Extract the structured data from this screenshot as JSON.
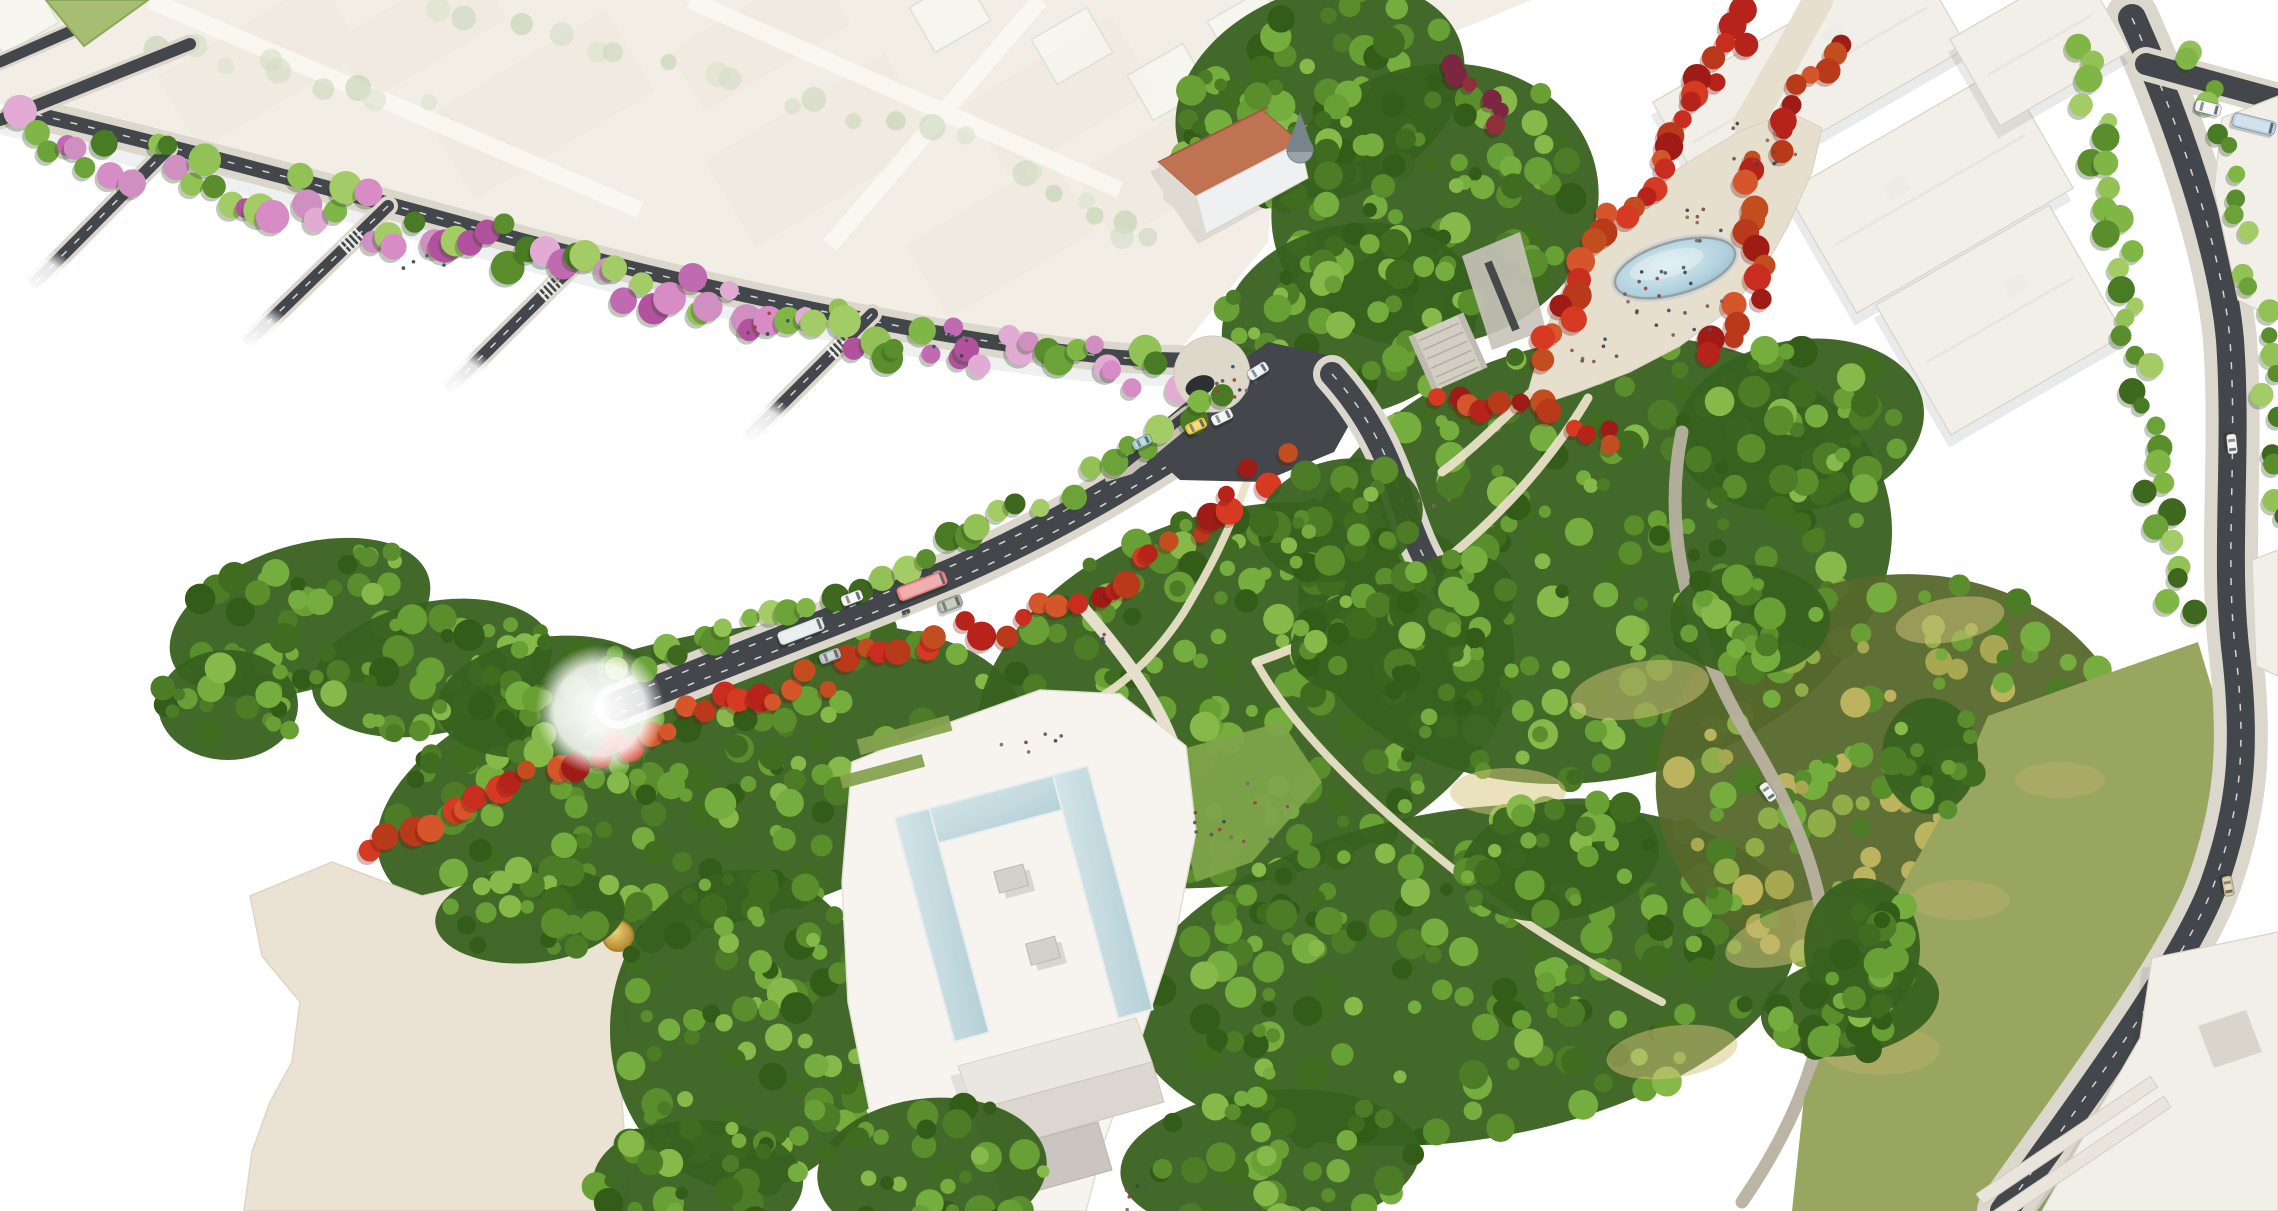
{
  "scene": {
    "title": "Aerial architectural rendering of an urban masterplan: tree-lined boulevard with buses, red-tree promenade with oval fountain, dense park, museum forecourt with U-shaped reflecting pool, white massing buildings and faded city context",
    "type": "architectural-visualization",
    "view": "aerial-isometric"
  },
  "colors": {
    "bg": "#ffffff",
    "fadedBase": "#ece4d5",
    "fadedBlock": "#e3d9c6",
    "fadedStreet": "#f7f3ea",
    "road": "#43474b",
    "roadDark": "#303438",
    "sidewalk": "#dcd7cd",
    "promenade": "#e7dfce",
    "pathLight": "#e9e0c7",
    "gravel": "#b8b1a0",
    "parkBase": "#38611f",
    "parkBaseYellow": "#56682c",
    "oliveLawn": "#98a65f",
    "beigeLot": "#eae2d3",
    "plazaWhite": "#f7f4ef",
    "buildingWhite": "#f2efe9",
    "buildingStroke": "#d8d3c9",
    "buildingShade": "#dfdbd2",
    "buildingDark": "#c7c3bb",
    "terracotta": "#bf7352",
    "terracottaDark": "#a05a40",
    "turret": "#9aa4a8",
    "turretDark": "#77858a",
    "pondRim": "#98a0a4",
    "laneDash": "#eceeea",
    "crosswalk": "#f7f7f4",
    "shadow": "#8d939c",
    "lawnBright": "#7fa44b",
    "hedge": "#86a24f",
    "glass": "rgba(246,250,243,0.55)",
    "glassStroke": "#c4cfbd"
  },
  "palettes": {
    "green": [
      "#497a24",
      "#5a8e2d",
      "#6ca338",
      "#7fb646",
      "#92c256",
      "#3d681d",
      "#a3cc66"
    ],
    "mixGreenPink": [
      "#5a8e2d",
      "#6ca338",
      "#7fb646",
      "#92c256",
      "#c06ab2",
      "#b2519e",
      "#d78cc5",
      "#e2abd3",
      "#497a24",
      "#a3cc66",
      "#cf8fc0"
    ],
    "red": [
      "#b5231b",
      "#c92d1f",
      "#d63a22",
      "#9e1c15",
      "#c24e1f",
      "#d4562a",
      "#b93a1a"
    ],
    "ghost": [
      "#aabf92",
      "#b9c8a1",
      "#c6d2ad",
      "#9db581"
    ],
    "park": [
      "#3f6c1e",
      "#4c7d26",
      "#5a8e2d",
      "#68a036",
      "#76ad3f",
      "#335c18",
      "#86b94a"
    ],
    "parkYellow": [
      "#4c7d26",
      "#5a8e2d",
      "#76ad3f",
      "#8fae4a",
      "#a8a852",
      "#bcb35e",
      "#68a036"
    ],
    "accent": [
      "#7c2742",
      "#8e2f3a",
      "#6e2030"
    ],
    "people": [
      "#3a3f4a",
      "#6b4a3a",
      "#874f5a",
      "#2f4a6b",
      "#4f555e",
      "#7a6a5a",
      "#a03c3c"
    ],
    "shadows": {
      "green": "#2c481a",
      "mixGreenPink": "#2c481a",
      "park": "#24420f",
      "parkYellow": "#3a4a14",
      "red": "#6e1410",
      "accent": "#451020",
      "ghost": "none"
    }
  },
  "canopy": {
    "bands": [
      {
        "name": "quay-avenue-row",
        "layer": "g-quay-trees",
        "points": [
          [
            15,
            132
          ],
          [
            180,
            172
          ],
          [
            350,
            212
          ],
          [
            520,
            252
          ],
          [
            700,
            296
          ],
          [
            870,
            332
          ],
          [
            1020,
            360
          ],
          [
            1160,
            374
          ],
          [
            1268,
            360
          ]
        ],
        "n": 88,
        "spread": 24,
        "r": [
          9,
          17
        ],
        "palette": "mixGreenPink"
      },
      {
        "name": "boulevard-upper-row",
        "layer": "g-blvd-trees",
        "points": [
          [
            608,
            684
          ],
          [
            700,
            646
          ],
          [
            790,
            610
          ],
          [
            880,
            576
          ],
          [
            960,
            540
          ],
          [
            1040,
            502
          ],
          [
            1110,
            464
          ],
          [
            1170,
            428
          ],
          [
            1240,
            386
          ]
        ],
        "n": 30,
        "spread": 13,
        "r": [
          9,
          15
        ],
        "palette": "green"
      },
      {
        "name": "boulevard-red-band",
        "layer": "g-blvd-trees",
        "points": [
          [
            368,
            847
          ],
          [
            470,
            797
          ],
          [
            560,
            759
          ],
          [
            650,
            727
          ],
          [
            735,
            702
          ],
          [
            820,
            677
          ],
          [
            900,
            652
          ],
          [
            980,
            630
          ],
          [
            1055,
            610
          ],
          [
            1110,
            582
          ],
          [
            1155,
            550
          ],
          [
            1200,
            517
          ],
          [
            1245,
            484
          ],
          [
            1292,
            457
          ]
        ],
        "n": 52,
        "spread": 15,
        "r": [
          8,
          15
        ],
        "palette": "red"
      },
      {
        "name": "promenade-red-west",
        "layer": "g-promenade-trees",
        "points": [
          [
            1758,
            12
          ],
          [
            1718,
            72
          ],
          [
            1676,
            132
          ],
          [
            1636,
            192
          ],
          [
            1596,
            252
          ],
          [
            1566,
            312
          ],
          [
            1548,
            368
          ]
        ],
        "n": 30,
        "spread": 15,
        "r": [
          9,
          15
        ],
        "palette": "red"
      },
      {
        "name": "promenade-red-east",
        "layer": "g-promenade-trees",
        "points": [
          [
            1838,
            35
          ],
          [
            1800,
            95
          ],
          [
            1768,
            150
          ],
          [
            1752,
            205
          ],
          [
            1764,
            262
          ],
          [
            1742,
            318
          ],
          [
            1700,
            360
          ]
        ],
        "n": 24,
        "spread": 13,
        "r": [
          8,
          14
        ],
        "palette": "red"
      },
      {
        "name": "promenade-red-south",
        "layer": "g-promenade-trees",
        "points": [
          [
            1432,
            390
          ],
          [
            1470,
            416
          ],
          [
            1528,
            400
          ],
          [
            1580,
            424
          ],
          [
            1628,
            442
          ]
        ],
        "n": 12,
        "spread": 12,
        "r": [
          8,
          13
        ],
        "palette": "red"
      },
      {
        "name": "purple-accents",
        "layer": "g-park-over",
        "points": [
          [
            1448,
            52
          ],
          [
            1482,
            92
          ],
          [
            1506,
            132
          ]
        ],
        "n": 6,
        "spread": 14,
        "r": [
          7,
          12
        ],
        "palette": "accent"
      },
      {
        "name": "street-row-west",
        "layer": "g-street-trees",
        "points": [
          [
            2085,
            42
          ],
          [
            2100,
            142
          ],
          [
            2118,
            242
          ],
          [
            2134,
            332
          ],
          [
            2150,
            432
          ],
          [
            2160,
            532
          ],
          [
            2186,
            622
          ]
        ],
        "n": 34,
        "spread": 15,
        "r": [
          8,
          14
        ],
        "palette": "green"
      },
      {
        "name": "street-row-east",
        "layer": "g-street-trees",
        "points": [
          [
            2192,
            30
          ],
          [
            2216,
            130
          ],
          [
            2246,
            230
          ],
          [
            2262,
            330
          ],
          [
            2270,
            430
          ],
          [
            2273,
            530
          ]
        ],
        "n": 22,
        "spread": 12,
        "r": [
          8,
          13
        ],
        "palette": "green"
      },
      {
        "name": "ghost-row-a",
        "layer": "g-ghost",
        "points": [
          [
            420,
            6
          ],
          [
            560,
            40
          ],
          [
            700,
            76
          ],
          [
            850,
            112
          ],
          [
            990,
            146
          ]
        ],
        "n": 15,
        "spread": 9,
        "r": [
          8,
          14
        ],
        "palette": "ghost",
        "opacity": 0.6
      },
      {
        "name": "ghost-row-b",
        "layer": "g-ghost",
        "points": [
          [
            150,
            40
          ],
          [
            290,
            72
          ],
          [
            430,
            106
          ]
        ],
        "n": 9,
        "spread": 9,
        "r": [
          8,
          14
        ],
        "palette": "ghost",
        "opacity": 0.6
      },
      {
        "name": "ghost-row-c",
        "layer": "g-ghost",
        "points": [
          [
            1010,
            168
          ],
          [
            1092,
            212
          ],
          [
            1164,
            252
          ]
        ],
        "n": 8,
        "spread": 9,
        "r": [
          8,
          13
        ],
        "palette": "ghost",
        "opacity": 0.6
      }
    ],
    "blobs": [
      {
        "cx": 700,
        "cy": 782,
        "rx": 330,
        "ry": 145,
        "rot": -13,
        "n": 165,
        "palette": "park"
      },
      {
        "cx": 1245,
        "cy": 695,
        "rx": 275,
        "ry": 185,
        "rot": -16,
        "n": 165,
        "palette": "park"
      },
      {
        "cx": 1595,
        "cy": 560,
        "rx": 300,
        "ry": 220,
        "rot": -12,
        "n": 190,
        "palette": "park"
      },
      {
        "cx": 1465,
        "cy": 975,
        "rx": 335,
        "ry": 165,
        "rot": -9,
        "n": 170,
        "palette": "park"
      },
      {
        "cx": 1895,
        "cy": 775,
        "rx": 240,
        "ry": 200,
        "rot": -8,
        "n": 130,
        "palette": "parkYellow"
      },
      {
        "cx": 1320,
        "cy": 95,
        "rx": 150,
        "ry": 105,
        "rot": -22,
        "n": 72,
        "palette": "park"
      },
      {
        "cx": 1435,
        "cy": 205,
        "rx": 165,
        "ry": 140,
        "rot": -14,
        "n": 88,
        "palette": "park"
      },
      {
        "cx": 1350,
        "cy": 320,
        "rx": 130,
        "ry": 95,
        "rot": -14,
        "n": 56,
        "palette": "park"
      },
      {
        "cx": 300,
        "cy": 618,
        "rx": 135,
        "ry": 72,
        "rot": -18,
        "n": 44,
        "palette": "park"
      },
      {
        "cx": 432,
        "cy": 668,
        "rx": 122,
        "ry": 66,
        "rot": -12,
        "n": 38,
        "palette": "park"
      },
      {
        "cx": 548,
        "cy": 697,
        "rx": 112,
        "ry": 60,
        "rot": -8,
        "n": 34,
        "palette": "park"
      },
      {
        "cx": 228,
        "cy": 705,
        "rx": 70,
        "ry": 55,
        "rot": 0,
        "n": 18,
        "palette": "park"
      },
      {
        "cx": 1800,
        "cy": 425,
        "rx": 125,
        "ry": 85,
        "rot": -10,
        "n": 42,
        "palette": "park"
      },
      {
        "cx": 1270,
        "cy": 1162,
        "rx": 150,
        "ry": 72,
        "rot": -5,
        "n": 40,
        "palette": "park"
      },
      {
        "cx": 530,
        "cy": 915,
        "rx": 95,
        "ry": 48,
        "rot": -5,
        "n": 26,
        "palette": "park",
        "layer": "g-lot-trees"
      },
      {
        "cx": 745,
        "cy": 1030,
        "rx": 135,
        "ry": 160,
        "rot": 0,
        "n": 88,
        "palette": "park",
        "layer": "g-lot-trees"
      },
      {
        "cx": 698,
        "cy": 1182,
        "rx": 105,
        "ry": 62,
        "rot": 0,
        "n": 30,
        "palette": "park",
        "layer": "g-lot-trees"
      },
      {
        "cx": 1380,
        "cy": 640,
        "rx": 90,
        "ry": 55,
        "rot": -10,
        "n": 26,
        "palette": "park",
        "layer": "g-park-over"
      },
      {
        "cx": 1560,
        "cy": 860,
        "rx": 100,
        "ry": 60,
        "rot": -10,
        "n": 28,
        "palette": "park",
        "layer": "g-park-over"
      },
      {
        "cx": 1750,
        "cy": 620,
        "rx": 80,
        "ry": 55,
        "rot": 0,
        "n": 22,
        "palette": "park",
        "layer": "g-park-over"
      },
      {
        "cx": 1452,
        "cy": 600,
        "rx": 64,
        "ry": 46,
        "rot": -14,
        "n": 18,
        "palette": "park",
        "layer": "g-blvd-trees"
      },
      {
        "cx": 1340,
        "cy": 520,
        "rx": 84,
        "ry": 60,
        "rot": -14,
        "n": 26,
        "palette": "park",
        "layer": "g-blvd-trees"
      },
      {
        "cx": 932,
        "cy": 1170,
        "rx": 115,
        "ry": 72,
        "rot": -5,
        "n": 34,
        "palette": "park",
        "layer": "g-blvd-trees"
      },
      {
        "cx": 1850,
        "cy": 1005,
        "rx": 90,
        "ry": 50,
        "rot": -10,
        "n": 24,
        "palette": "park",
        "layer": "g-street-trees"
      },
      {
        "cx": 1862,
        "cy": 948,
        "rx": 58,
        "ry": 70,
        "rot": 0,
        "n": 18,
        "palette": "park",
        "layer": "g-street-trees"
      },
      {
        "cx": 1930,
        "cy": 756,
        "rx": 48,
        "ry": 58,
        "rot": 0,
        "n": 14,
        "palette": "park",
        "layer": "g-street-trees"
      }
    ]
  },
  "crosswalks": [
    {
      "x": 142,
      "y": 176,
      "a": 135,
      "n": 5,
      "len": 15
    },
    {
      "x": 360,
      "y": 233,
      "a": 137,
      "n": 5,
      "len": 15
    },
    {
      "x": 558,
      "y": 280,
      "a": 137,
      "n": 5,
      "len": 15
    },
    {
      "x": 848,
      "y": 338,
      "a": 137,
      "n": 5,
      "len": 15
    },
    {
      "x": 2186,
      "y": 76,
      "a": 15,
      "n": 6,
      "len": 16
    },
    {
      "x": 1336,
      "y": 412,
      "a": 46,
      "n": 5,
      "len": 16
    }
  ],
  "vehicles": [
    {
      "type": "bus",
      "color": "#e88585",
      "x": 922,
      "y": 586,
      "angle": -21,
      "w": 52,
      "h": 15
    },
    {
      "type": "bus",
      "color": "#dfe9e6",
      "x": 801,
      "y": 631,
      "angle": -21,
      "w": 48,
      "h": 14
    },
    {
      "type": "car",
      "color": "#f4f4f2",
      "x": 852,
      "y": 598,
      "angle": -21,
      "w": 22,
      "h": 11
    },
    {
      "type": "car",
      "color": "#b9bdc4",
      "x": 830,
      "y": 656,
      "angle": -21,
      "w": 22,
      "h": 11
    },
    {
      "type": "van",
      "color": "#aab3a0",
      "x": 950,
      "y": 604,
      "angle": -21,
      "w": 25,
      "h": 12
    },
    {
      "type": "moto",
      "color": "#494f56",
      "x": 906,
      "y": 612,
      "angle": -21,
      "w": 8,
      "h": 4
    },
    {
      "type": "car",
      "color": "#ecc93e",
      "x": 1196,
      "y": 426,
      "angle": -26,
      "w": 22,
      "h": 11
    },
    {
      "type": "car",
      "color": "#f2f2f0",
      "x": 1222,
      "y": 417,
      "angle": -26,
      "w": 22,
      "h": 11
    },
    {
      "type": "car",
      "color": "#eef0f2",
      "x": 1258,
      "y": 371,
      "angle": -32,
      "w": 22,
      "h": 11
    },
    {
      "type": "car",
      "color": "#9fd0cd",
      "x": 1142,
      "y": 442,
      "angle": -26,
      "w": 20,
      "h": 10
    },
    {
      "type": "van",
      "color": "#f4f4f2",
      "x": 2208,
      "y": 108,
      "angle": 14,
      "w": 26,
      "h": 12
    },
    {
      "type": "bus",
      "color": "#b8d3e2",
      "x": 2254,
      "y": 124,
      "angle": 14,
      "w": 44,
      "h": 14
    },
    {
      "type": "car",
      "color": "#f2f2f0",
      "x": 1768,
      "y": 792,
      "angle": 55,
      "w": 20,
      "h": 10
    },
    {
      "type": "car",
      "color": "#f0efec",
      "x": 2232,
      "y": 444,
      "angle": 84,
      "w": 20,
      "h": 10
    },
    {
      "type": "car",
      "color": "#d8c89a",
      "x": 2228,
      "y": 886,
      "angle": 80,
      "w": 20,
      "h": 10
    }
  ],
  "people": [
    {
      "x": 1678,
      "y": 300,
      "n": 22,
      "spread": 60
    },
    {
      "x": 1760,
      "y": 140,
      "n": 10,
      "spread": 45
    },
    {
      "x": 1700,
      "y": 225,
      "n": 8,
      "spread": 35
    },
    {
      "x": 1600,
      "y": 352,
      "n": 7,
      "spread": 30
    },
    {
      "x": 1228,
      "y": 380,
      "n": 9,
      "spread": 30
    },
    {
      "x": 1240,
      "y": 815,
      "n": 12,
      "spread": 55
    },
    {
      "x": 1035,
      "y": 748,
      "n": 6,
      "spread": 42
    },
    {
      "x": 1120,
      "y": 1196,
      "n": 5,
      "spread": 30
    },
    {
      "x": 762,
      "y": 322,
      "n": 5,
      "spread": 26
    },
    {
      "x": 424,
      "y": 266,
      "n": 4,
      "spread": 22
    },
    {
      "x": 958,
      "y": 346,
      "n": 5,
      "spread": 26
    },
    {
      "x": 1425,
      "y": 500,
      "n": 4,
      "spread": 26
    },
    {
      "x": 1100,
      "y": 640,
      "n": 4,
      "spread": 22
    }
  ],
  "seed": 7
}
